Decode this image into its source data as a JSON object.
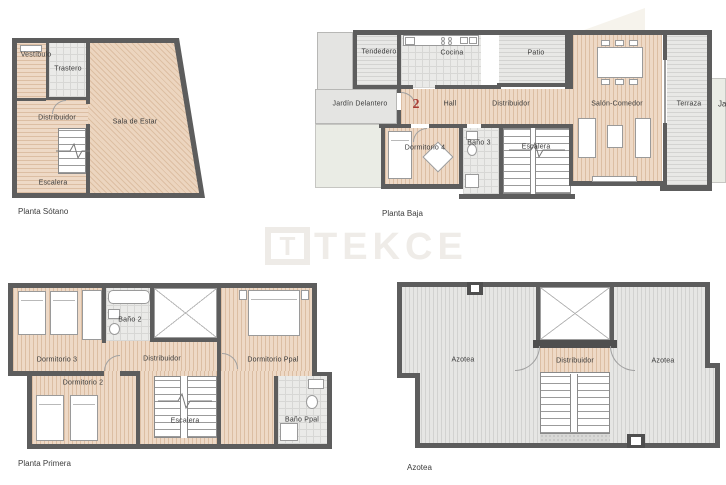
{
  "watermark": {
    "logo_letter": "T",
    "brand": "TEKCE"
  },
  "colors": {
    "wall": "#5d5d5d",
    "wood": "#eed9c6",
    "tile": "#eaeae8",
    "outdoor": "#e7e7e5",
    "garden": "#eaece5",
    "accent_red": "#a93a31"
  },
  "plans": {
    "sotano": {
      "caption": "Planta Sótano",
      "rooms": {
        "vestibulo": "Vestíbulo",
        "trastero": "Trastero",
        "distribuidor": "Distribuidor",
        "sala_de_estar": "Sala de Estar",
        "escalera": "Escalera"
      }
    },
    "baja": {
      "caption": "Planta Baja",
      "unit_number": "2",
      "rooms": {
        "tendedero": "Tendedero",
        "cocina": "Cocina",
        "patio": "Patio",
        "jardin_delantero": "Jardín Delantero",
        "hall": "Hall",
        "distribuidor": "Distribuidor",
        "salon_comedor": "Salón-Comedor",
        "terraza": "Terraza",
        "jardin": "Jardín",
        "dormitorio4": "Dormitorio 4",
        "bano3": "Baño 3",
        "escalera": "Escalera"
      }
    },
    "primera": {
      "caption": "Planta Primera",
      "rooms": {
        "dormitorio3": "Dormitorio 3",
        "bano2": "Baño 2",
        "dormitorio2": "Dormitorio 2",
        "distribuidor": "Distribuidor",
        "dormitorio_ppal": "Dormitorio Ppal",
        "escalera": "Escalera",
        "bano_ppal": "Baño Ppal"
      }
    },
    "azotea": {
      "caption": "Azotea",
      "rooms": {
        "azotea_left": "Azotea",
        "distribuidor": "Distribuidor",
        "azotea_right": "Azotea"
      }
    }
  }
}
